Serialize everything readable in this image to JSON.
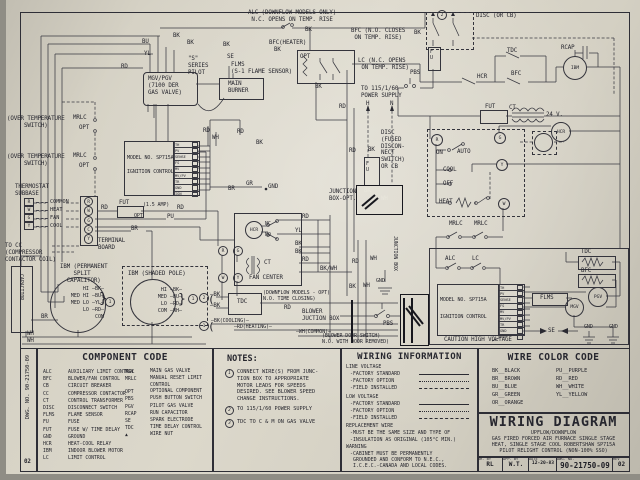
{
  "schematic": {
    "labels": {
      "alc1": "ALC (DOWNFLOW MODELS ONLY)\n N.C. OPENS ON TEMP. RISE",
      "bk1": "BK",
      "bk2": "BK",
      "bk3": "BK",
      "bk4": "BK",
      "bk5": "BK",
      "bk6": "BK",
      "bk7": "BK",
      "bk8": "BK",
      "bk9": "—BK",
      "bk10": "—BK",
      "bk11": "BK",
      "bk12": "BK",
      "bk13": "BK",
      "bk14": "BK",
      "bk15": "BK",
      "bu1": "BU",
      "yl1": "YL",
      "yl2": "YL",
      "rd1": "RD",
      "rd2": "RD",
      "rd3": "RD",
      "rd4": "RD",
      "rd5": "RD",
      "rd6": "RD",
      "rd7": "RD",
      "rd8": "RD",
      "rd9": "RD",
      "rd10": "RD",
      "rd11": "RD",
      "wh1": "WH",
      "wh2": "WH",
      "wh3": "WH",
      "wh4": "WH",
      "wh5": "WH",
      "wh6": "WH",
      "pu1": "PU",
      "br1": "BR",
      "br2": "BR",
      "br3": "BR",
      "gr1": "GR",
      "bkwh": "BK/WH",
      "sser": "\"S\"\nSERIES\nPILOT",
      "se1": "SE",
      "se2": "SE",
      "flms1": "FLMS\n(S-1 FLAME SENSOR)",
      "flms2": "FLMS",
      "mgvbox": "MGV/PGV\n(7100 DER\nGAS VALVE)",
      "burner": "MAIN\nBURNER",
      "bfch": "BFC(HEATER)",
      "opt1": "OPT",
      "bfcn": "BFC (N.O. CLOSES\n ON TEMP. RISE)",
      "lcn": "LC (N.C. OPENS\n ON TEMP. RISE)",
      "psn": "TO 115/1/60\nPOWER SUPPLY",
      "h1": "H",
      "n1": "N",
      "discn": "DISC\n(FUSED\nDISCON-\nNECT\nSWITCH)\nOR CB",
      "discor": "DISC (OR CB)",
      "jb1": "JUNCTION\nBOX-OPT.",
      "jb2": "JUNCTION BOX",
      "pbs1": "PBS",
      "pbs2": "PBS",
      "fu1": "F\nU",
      "fu2": "F\nU",
      "hcr1": "HCR",
      "hcr2": "HCR",
      "hcr3": "HCR",
      "tdc1": "TDC",
      "tdc2": "TDC",
      "tdc3": "TDC",
      "bfc1": "BFC",
      "bfc2": "BFC",
      "rcap1": "RCAP",
      "ibm1": "IBM",
      "fut1": "FUT",
      "fut2": "FUT",
      "amp": "(1.5 AMP)",
      "opt4": "OPT",
      "ct1": "CT",
      "ct2": "CT",
      "v24": "24 V.",
      "on1": "ON",
      "auto1": "AUTO",
      "cool1": "COOL",
      "off1": "OFF",
      "heat1": "HEAT",
      "mrlc1": "MRLC",
      "mrlc2": "MRLC",
      "mrlc3": "MRLC",
      "mrlc4": "MRLC",
      "opt2": "OPT",
      "opt3": "OPT",
      "alc2": "ALC",
      "lc2": "LC",
      "ignm1": "MODEL NO. SP715A",
      "ignc1": "IGNITION CONTROL",
      "ignm2": "MODEL NO. SP715A",
      "ignc2": "IGNITION CONTROL",
      "mgv1": "MGV",
      "pgv1": "PGV",
      "gnd1": "GND",
      "gnd2": "GND",
      "gnd3": "GND",
      "gnd4": "GND",
      "caution": "CAUTION HIGH VOLTAGE",
      "ots1": "(OVER TEMPERATURE\n     SWITCH)",
      "ots2": "(OVER TEMPERATURE\n     SWITCH)",
      "thermsub": "THERMOSTAT\nSUBBASE",
      "tocc": "TO CC\n(COMPRESSOR\nCONTACTOR COIL)",
      "tb1": "TERMINAL\nBOARD",
      "cap1": "CAPACITOR",
      "ibmp": "IBM (PERMANENT\n    SPLIT\n  CAPACITOR)",
      "ibms": "IBM (SHADED POLE)",
      "dfm": "(DOWNFLOW MODELS - OPT)\nN.O. TIME CLOSING)",
      "bjb": "BLOWER\nJUCTION BOX",
      "cool2": "—BK(COOLING)—",
      "heat2": "—RD(HEATING)—",
      "com2": "—WH(COMMON)—",
      "bds": "(BLOWER DOOR SWITCH)\nN.O. WITH DOOR REMOVED)",
      "fanc": "FAN CENTER",
      "nc1": "NC",
      "no1": "NO",
      "n1c": "1",
      "n2c": "2",
      "n1b": "1",
      "n1d": "1",
      "n2t": "2",
      "brA": "}",
      "brB": "}",
      "brC": "(",
      "brD": "(",
      "tR": "R",
      "tG": "G",
      "tY": "Y",
      "tW": "W",
      "fR": "R",
      "fG": "G",
      "fW": "W",
      "fY": "Y"
    },
    "ign_terminals": [
      "TH",
      "PV",
      "SENSE",
      "FS",
      "MV",
      "MV/PV",
      "TR",
      "GND",
      "IGN"
    ],
    "psc_rows": [
      "HI —BK—",
      "MED HI —BU—",
      "MED LO —YL—",
      "LO —RD—",
      "COM"
    ],
    "sp_rows": [
      "HI —BK—",
      "MED —BU—",
      "LO —RD—",
      "COM —WH—"
    ],
    "subbase_rows": [
      {
        "t": "R",
        "lbl": "COMMON"
      },
      {
        "t": "W",
        "lbl": "HEAT"
      },
      {
        "t": "G",
        "lbl": "FAN"
      },
      {
        "t": "Y",
        "lbl": "COOL"
      }
    ],
    "terminal_board": [
      "R",
      "W",
      "G",
      "C",
      "Y"
    ]
  },
  "tables": {
    "component_code": {
      "title": "COMPONENT CODE",
      "left": [
        {
          "c": "ALC",
          "d": "AUXILIARY LIMIT CONTROL"
        },
        {
          "c": "BFC",
          "d": "BLOWER/FAN CONTROL"
        },
        {
          "c": "CB",
          "d": "CIRCUIT BREAKER"
        },
        {
          "c": "CC",
          "d": "COMPRESSOR CONTACTOR"
        },
        {
          "c": "CT",
          "d": "CONTROL TRANSFORMER"
        },
        {
          "c": "DISC",
          "d": "DISCONNECT SWITCH"
        },
        {
          "c": "FLMS",
          "d": "FLAME SENSOR"
        },
        {
          "c": "FU",
          "d": "FUSE"
        },
        {
          "c": "FUT",
          "d": "FUSE W/ TIME DELAY"
        },
        {
          "c": "GND",
          "d": "GROUND"
        },
        {
          "c": "HCR",
          "d": "HEAT-COOL RELAY"
        },
        {
          "c": "IBM",
          "d": "INDOOR BLOWER MOTOR"
        },
        {
          "c": "LC",
          "d": "LIMIT CONTROL"
        }
      ],
      "right": [
        {
          "c": "MGV",
          "d": "MAIN GAS VALVE"
        },
        {
          "c": "MRLC",
          "d": "MANUAL RESET LIMIT CONTROL"
        },
        {
          "c": "OPT",
          "d": "OPTIONAL COMPONENT"
        },
        {
          "c": "PBS",
          "d": "PUSH BUTTON SWITCH"
        },
        {
          "c": "PGV",
          "d": "PILOT GAS VALVE"
        },
        {
          "c": "RCAP",
          "d": "RUN CAPACITOR"
        },
        {
          "c": "SE",
          "d": "SPARK ELECTRODE"
        },
        {
          "c": "TDC",
          "d": "TIME DELAY CONTROL"
        },
        {
          "c": "▲",
          "d": "WIRE NUT"
        }
      ]
    },
    "notes": {
      "title": "NOTES:",
      "items": [
        {
          "n": "1",
          "text": "CONNECT WIRE(S) FROM JUNC-\nTION BOX TO APPROPRIATE\nMOTOR LEADS FOR SPEEDS\nDESIRED. SEE BLOWER SPEED\nCHANGE INSTRUCTIONS."
        },
        {
          "n": "2",
          "text": "TO 115/1/60 POWER SUPPLY"
        },
        {
          "n": "3",
          "text": "TDC TO C & M ON GAS VALVE"
        }
      ]
    },
    "wiring_info": {
      "title": "WIRING INFORMATION",
      "lv": "LINE VOLTAGE",
      "fs": "-FACTORY STANDARD",
      "fo": "-FACTORY OPTION",
      "fi": "-FIELD INSTALLED",
      "low": "LOW VOLTAGE",
      "rep": "REPLACEMENT WIRE",
      "rep1": "-MUST BE THE SAME SIZE AND TYPE OF",
      "rep2": "-INSULATION AS ORIGINAL (105°C MIN.)",
      "warn": "WARNING",
      "warn1": "-CABINET MUST BE PERMANENTLY",
      "warn2": "GROUNDED AND CONFORM TO N.E.C.,",
      "warn3": "I.C.E.C.-CANADA AND LOCAL CODES."
    },
    "wire_colors": {
      "title": "WIRE COLOR CODE",
      "left": [
        "BK__BLACK",
        "BR__BROWN",
        "BU__BLUE",
        "GR__GREEN",
        "OR__ORANGE"
      ],
      "right": [
        "PU__PURPLE",
        "RD__RED",
        "WH__WHITE",
        "YL__YELLOW"
      ]
    },
    "title_block": {
      "title": "WIRING DIAGRAM",
      "sub1": "UPFLOW/DOWNFLOW",
      "sub2": "GAS FIRED FORCED AIR FURNACE SINGLE STAGE",
      "sub3": "HEAT, SINGLE STAGE COOL ROBERTSHAW SP715A",
      "sub4": "PILOT RELIGHT CONTROL (NON-100% SSO)",
      "dr_by_label": "DR. BY",
      "dr_by": "RL",
      "app_by_label": "APP. BY",
      "app_by": "W.T.",
      "date_label": "DATE",
      "date": "12-20-83",
      "dwg_label": "DWG. NO.",
      "dwg": "90-21750-09",
      "rev_label": "REV",
      "rev": "02"
    },
    "side_strip": {
      "dwg": "DWG. NO. 90-21750-09",
      "rev": "02"
    }
  }
}
